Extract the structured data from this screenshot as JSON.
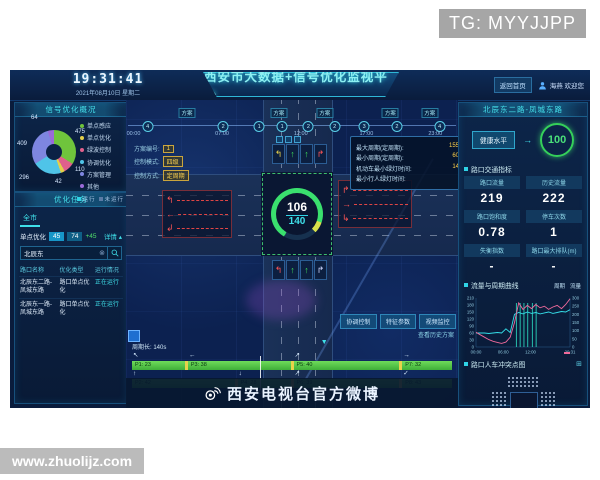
{
  "watermarks": {
    "tg": "TG: MYYJJPP",
    "site": "www.zhuolijz.com"
  },
  "header": {
    "time": "19:31:41",
    "date": "2021年08月10日 星期二",
    "title": "西安市大数据+信号优化监视平台",
    "home_link": "返回首页",
    "user": "海燕 欢迎您"
  },
  "left": {
    "overview": {
      "title": "信号优化概况",
      "legend": [
        {
          "label": "单点感应",
          "color": "#6fc43c"
        },
        {
          "label": "单点优化",
          "color": "#e3cf4a"
        },
        {
          "label": "绿波控制",
          "color": "#e0608c"
        },
        {
          "label": "协调优化",
          "color": "#4fc4e8"
        },
        {
          "label": "方案管理",
          "color": "#7e86e0"
        },
        {
          "label": "其他",
          "color": "#9a6ad8"
        }
      ]
    },
    "tasks": {
      "title": "优化任务",
      "legend": [
        {
          "label": "运行",
          "color": "#2fd3e6"
        },
        {
          "label": "未运行",
          "color": "#5a7ba6"
        }
      ],
      "tab": "全市",
      "stat": {
        "label": "单点优化",
        "v1": "45",
        "v2": "74",
        "delta": "+45",
        "detail": "详情 ▴"
      },
      "search": {
        "value": "北辰东",
        "clear_icon": "⊗"
      },
      "table": {
        "headers": [
          "路口名称",
          "优化类型",
          "运行情况"
        ],
        "rows": [
          {
            "name": "北辰东二路-凤城东路",
            "type": "路口单点优化",
            "status": "正在运行"
          },
          {
            "name": "北辰东一路-凤城东路",
            "type": "路口单点优化",
            "status": "正在运行"
          }
        ]
      }
    }
  },
  "map": {
    "timeline": {
      "tag_label": "方案",
      "tags": [
        {
          "x": 18
        },
        {
          "x": 46
        },
        {
          "x": 60
        },
        {
          "x": 80
        },
        {
          "x": 92
        }
      ],
      "markers": [
        {
          "x": 6,
          "n": "4"
        },
        {
          "x": 29,
          "n": "2"
        },
        {
          "x": 40,
          "n": "1"
        },
        {
          "x": 47,
          "n": "1"
        },
        {
          "x": 55,
          "n": "2"
        },
        {
          "x": 63,
          "n": "2"
        },
        {
          "x": 72,
          "n": "3"
        },
        {
          "x": 82,
          "n": "2"
        },
        {
          "x": 95,
          "n": "4"
        }
      ],
      "times": [
        {
          "x": 0,
          "t": "00:00"
        },
        {
          "x": 27,
          "t": "07:00"
        },
        {
          "x": 51,
          "t": "12:00"
        },
        {
          "x": 71,
          "t": "17:00"
        },
        {
          "x": 92,
          "t": "23:00"
        }
      ]
    },
    "control": {
      "rows": [
        {
          "label": "方案编号:",
          "value": "1"
        },
        {
          "label": "控制模式:",
          "value": "四级"
        },
        {
          "label": "控制方式:",
          "value": "定周期"
        }
      ]
    },
    "signal_info": {
      "lines": [
        {
          "label": "最大周期(定周期):",
          "value": "155s"
        },
        {
          "label": "最小周期(定周期):",
          "value": "60s"
        },
        {
          "label": "机动车最小绿灯时间:",
          "value": "14s"
        },
        {
          "label": "最小行人绿灯时间:",
          "value": "-"
        }
      ]
    },
    "intersection": {
      "current": "106",
      "cycle": "140",
      "top_arrows": [
        {
          "g": "↰",
          "color": "#e8d24a"
        },
        {
          "g": "↑",
          "color": "#3ddc5a"
        },
        {
          "g": "↑",
          "color": "#3ddc5a"
        },
        {
          "g": "↱",
          "color": "#ff5555"
        }
      ],
      "bottom_arrows": [
        {
          "g": "↰",
          "color": "#ff5555"
        },
        {
          "g": "↑",
          "color": "#3ddc5a"
        },
        {
          "g": "↑",
          "color": "#3ddc5a"
        },
        {
          "g": "↱",
          "color": "#cfd8ff"
        }
      ],
      "left_rows": [
        {
          "g": "↰"
        },
        {
          "g": "←"
        },
        {
          "g": "↲"
        }
      ],
      "right_rows": [
        {
          "g": "↱"
        },
        {
          "g": "→"
        },
        {
          "g": "↳"
        }
      ]
    },
    "buttons": [
      {
        "label": "协调控制"
      },
      {
        "label": "特征参数"
      },
      {
        "label": "视频监控"
      }
    ],
    "history_link": "查看历史方案",
    "phase": {
      "cycle_label": "周期长: 140s",
      "pointer": "▼",
      "cursor_label": "106",
      "row1": [
        {
          "w": 17,
          "arrow": "↖",
          "label": "P1: 23"
        },
        {
          "w": 33,
          "arrow": "←",
          "label": "P3: 38"
        },
        {
          "w": 34,
          "arrow": "↗",
          "label": "P5: 40"
        },
        {
          "w": 16,
          "arrow": "→",
          "label": "P7: 32"
        }
      ],
      "row2": [
        {
          "w": 33,
          "arrow": "↑",
          "label": "P2: 42"
        },
        {
          "w": 17,
          "arrow": "↓",
          "label": "P4: 28"
        },
        {
          "w": 34,
          "arrow": "↗",
          "label": "P6: 39"
        },
        {
          "w": 16,
          "arrow": "✓",
          "label": "P8: 43"
        }
      ]
    },
    "weibo_caption": "西安电视台官方微博"
  },
  "right": {
    "title": "北辰东二路-凤城东路",
    "health": {
      "label": "健康水平",
      "arrow": "→",
      "value": "100"
    },
    "metrics_title": "路口交通指标",
    "metrics": [
      {
        "label": "路口流量",
        "value": "219"
      },
      {
        "label": "历史流量",
        "value": "222"
      },
      {
        "label": "路口饱和度",
        "value": "0.78"
      },
      {
        "label": "停车次数",
        "value": "1"
      },
      {
        "label": "失衡指数",
        "value": "-"
      },
      {
        "label": "路口最大排队(m)",
        "value": "-"
      }
    ],
    "trend_title": "流量与周期曲线",
    "conflict_title": "路口人车冲突点图",
    "expand_icon": "⊞"
  },
  "chart_data": [
    {
      "type": "pie",
      "title": "信号优化概况",
      "segments": [
        {
          "label": "单点感应",
          "value": 475,
          "color": "#6fc43c"
        },
        {
          "label": "绿波控制",
          "value": 110,
          "color": "#e0608c"
        },
        {
          "label": "单点优化",
          "value": 42,
          "color": "#e3cf4a"
        },
        {
          "label": "协调优化",
          "value": 296,
          "color": "#4fc4e8"
        },
        {
          "label": "方案管理",
          "value": 409,
          "color": "#7e86e0"
        },
        {
          "label": "其他",
          "value": 64,
          "color": "#9a6ad8"
        }
      ]
    },
    {
      "type": "line",
      "title": "流量与周期曲线",
      "x_labels": [
        "00:00",
        "06:00",
        "12:00",
        "20:31"
      ],
      "left_axis": {
        "label": "周期",
        "min": 0,
        "max": 210,
        "step": 30
      },
      "right_axis": {
        "label": "流量",
        "min": 0,
        "max": 300,
        "step": 50
      },
      "series": [
        {
          "name": "周期",
          "color": "#35e0ea",
          "axis": "left",
          "values": [
            60,
            60,
            60,
            58,
            60,
            62,
            60,
            78,
            62,
            140,
            148,
            142,
            150,
            144,
            148,
            142,
            146,
            150,
            144,
            148,
            152,
            150,
            160
          ]
        },
        {
          "name": "流量",
          "color": "#ef6a9b",
          "axis": "right",
          "values": [
            90,
            75,
            60,
            45,
            35,
            28,
            22,
            30,
            60,
            150,
            270,
            230,
            255,
            235,
            260,
            240,
            250,
            230,
            245,
            255,
            235,
            260,
            295
          ]
        }
      ],
      "spikes": {
        "x": [
          0.43,
          0.47,
          0.51,
          0.55,
          0.6,
          0.64
        ],
        "color": "#2ee6c8"
      }
    }
  ]
}
